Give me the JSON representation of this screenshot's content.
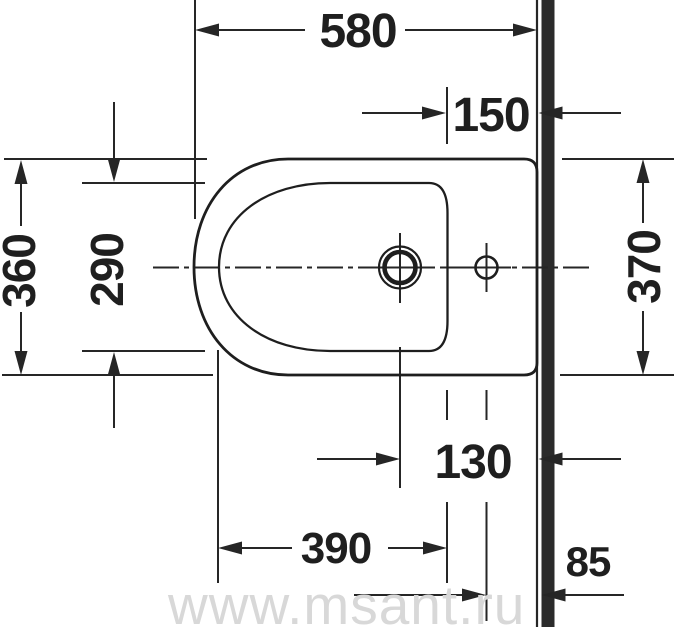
{
  "drawing": {
    "subject": "bidet-top-view-dimension-drawing",
    "watermark": "www.msant.ru",
    "colors": {
      "line": "#262626",
      "outline": "#1e1e1e",
      "wall": "#2b2b2b",
      "text": "#1f1f1f",
      "watermark": "#d8d8d8",
      "background": "#ffffff"
    },
    "dims": {
      "overall_depth": {
        "value": "580",
        "orientation": "horizontal"
      },
      "rim_to_wall": {
        "value": "150",
        "orientation": "horizontal"
      },
      "overall_width": {
        "value": "360",
        "orientation": "vertical"
      },
      "inner_width": {
        "value": "290",
        "orientation": "vertical"
      },
      "width_at_wall": {
        "value": "370",
        "orientation": "vertical"
      },
      "hole_to_wall": {
        "value": "130",
        "orientation": "horizontal"
      },
      "inner_depth": {
        "value": "390",
        "orientation": "horizontal"
      },
      "outlet_to_wall": {
        "value": "85",
        "orientation": "horizontal"
      }
    }
  }
}
